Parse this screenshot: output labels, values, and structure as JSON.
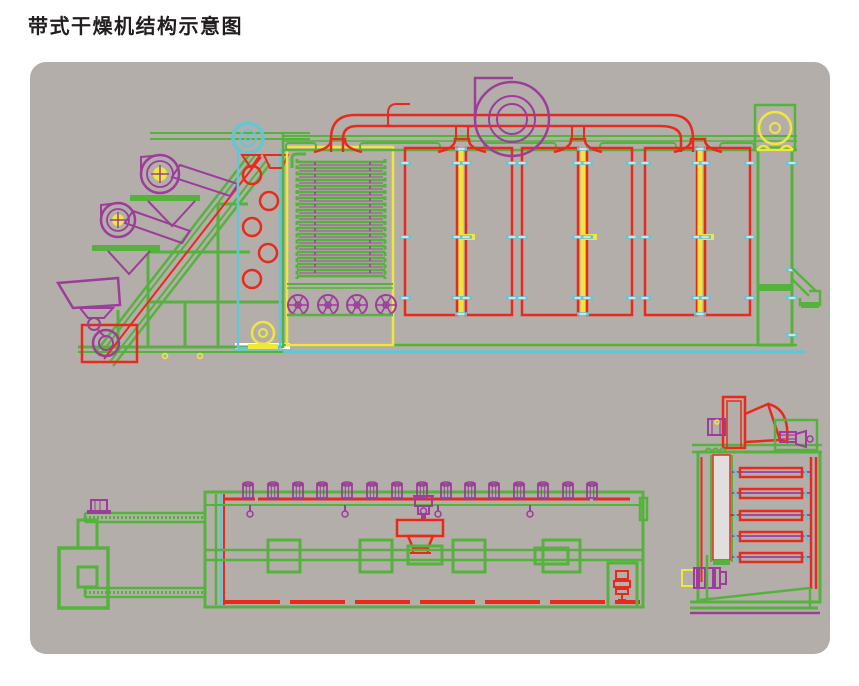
{
  "page": {
    "title": "带式干燥机结构示意图"
  },
  "palette": {
    "green": "#55b23c",
    "red": "#e82a1c",
    "purple": "#9c3d9a",
    "yellow": "#efe73c",
    "cyan": "#64c5d6",
    "panel": "#b4aeaa",
    "page": "#ffffff",
    "titleColor": "#221e1f",
    "white": "#ffffff"
  }
}
